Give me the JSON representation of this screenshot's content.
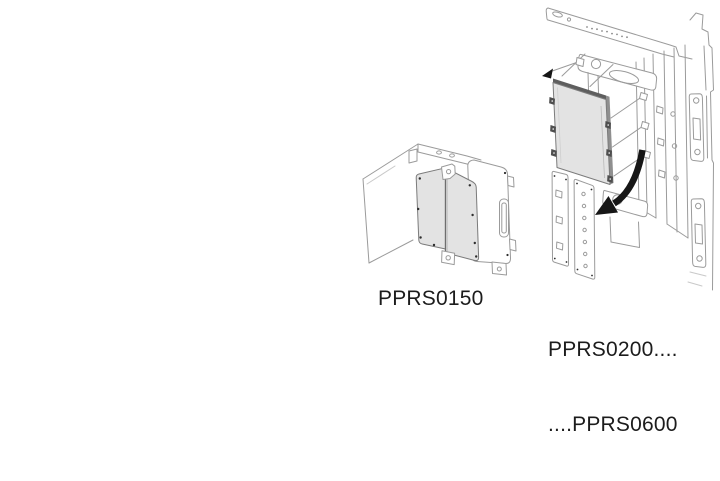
{
  "colors": {
    "page_bg": "#ffffff",
    "outline_gray": "#9b9b9b",
    "panel_fill": "#e3e3e3",
    "panel_edge": "#7b7b7b",
    "panel_depth": "#5e5e5e",
    "arrow_black": "#161616",
    "label_text": "#1c1c1c"
  },
  "figures": [
    {
      "id": "pprs0150",
      "label": "PPRS0150",
      "illustration": "hinged-blanking-panel-in-corner-frame"
    },
    {
      "id": "pprs0200-0600",
      "label_line1": "PPRS0200....",
      "label_line2": "....PPRS0600",
      "illustration": "blanking-panel-with-fasteners-and-mounting-strips"
    }
  ]
}
